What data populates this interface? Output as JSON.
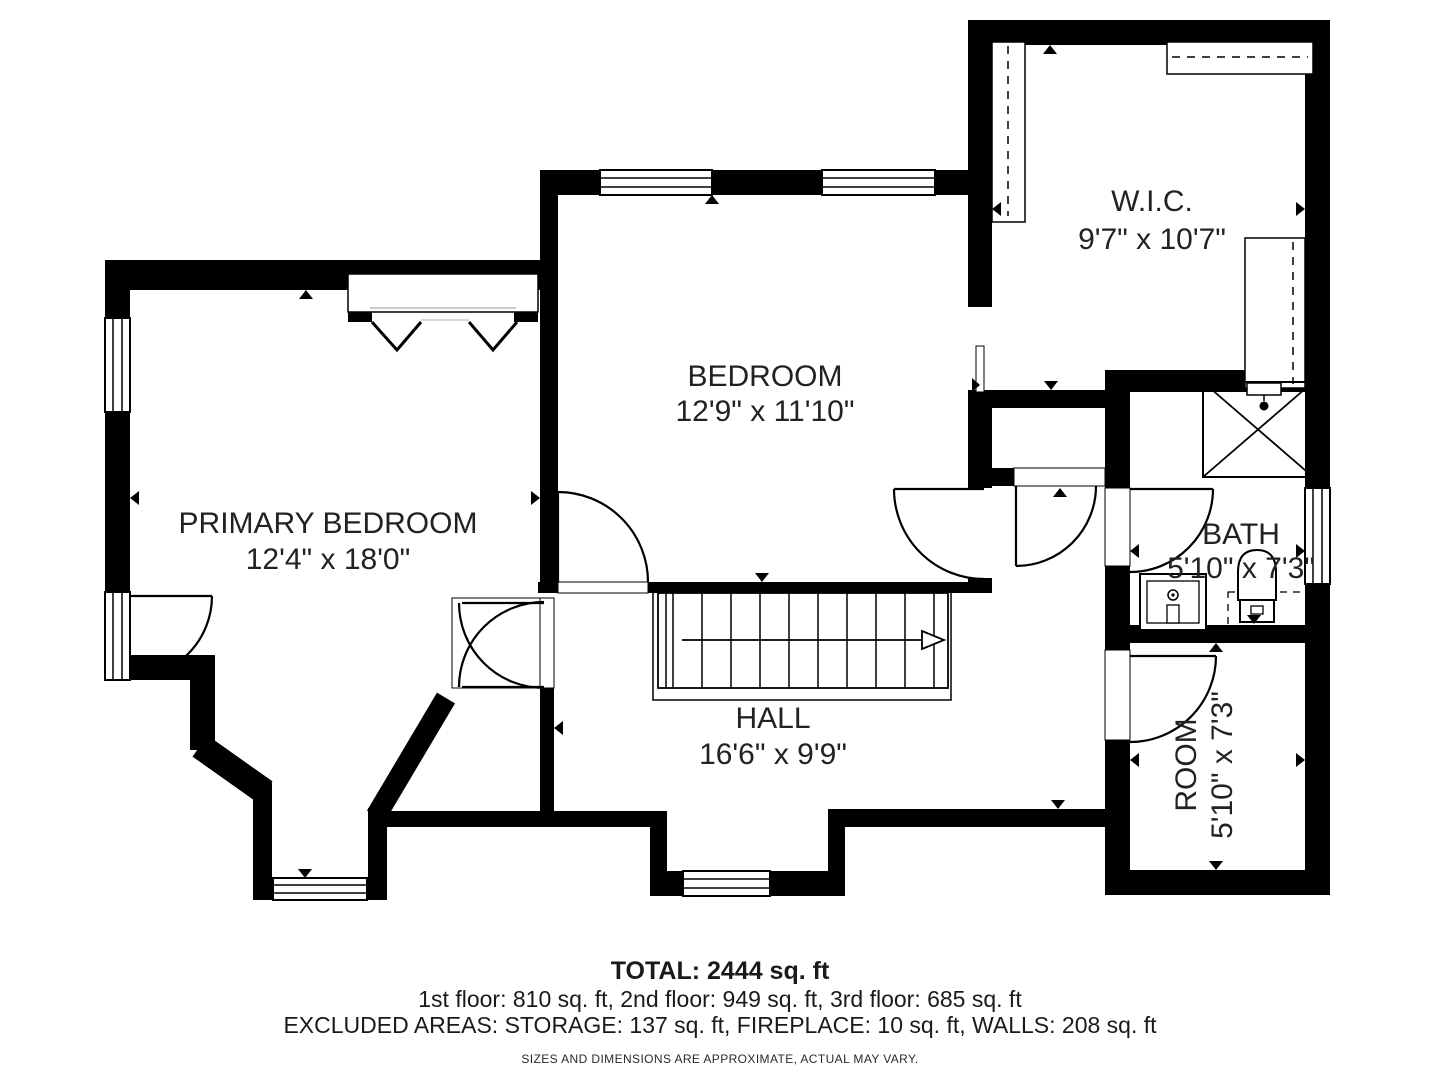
{
  "plan": {
    "rooms": [
      {
        "id": "wic",
        "name": "W.I.C.",
        "dims": "9'7\" x 10'7\""
      },
      {
        "id": "bedroom",
        "name": "BEDROOM",
        "dims": "12'9\" x 11'10\""
      },
      {
        "id": "primary-bedroom",
        "name": "PRIMARY BEDROOM",
        "dims": "12'4\" x 18'0\""
      },
      {
        "id": "bath",
        "name": "BATH",
        "dims": "5'10\" x 7'3\""
      },
      {
        "id": "hall",
        "name": "HALL",
        "dims": "16'6\" x 9'9\""
      },
      {
        "id": "room",
        "name": "ROOM",
        "dims": "5'10\" x 7'3\""
      }
    ],
    "colors": {
      "wall": "#000000",
      "floor": "#ffffff",
      "label": "#222222"
    }
  },
  "footer": {
    "total": "TOTAL: 2444 sq. ft",
    "floors": "1st floor: 810 sq. ft, 2nd floor: 949 sq. ft, 3rd floor: 685 sq. ft",
    "excluded": "EXCLUDED AREAS: STORAGE: 137 sq. ft, FIREPLACE: 10 sq. ft, WALLS: 208 sq. ft",
    "disclaimer": "SIZES AND DIMENSIONS ARE APPROXIMATE, ACTUAL MAY VARY."
  }
}
